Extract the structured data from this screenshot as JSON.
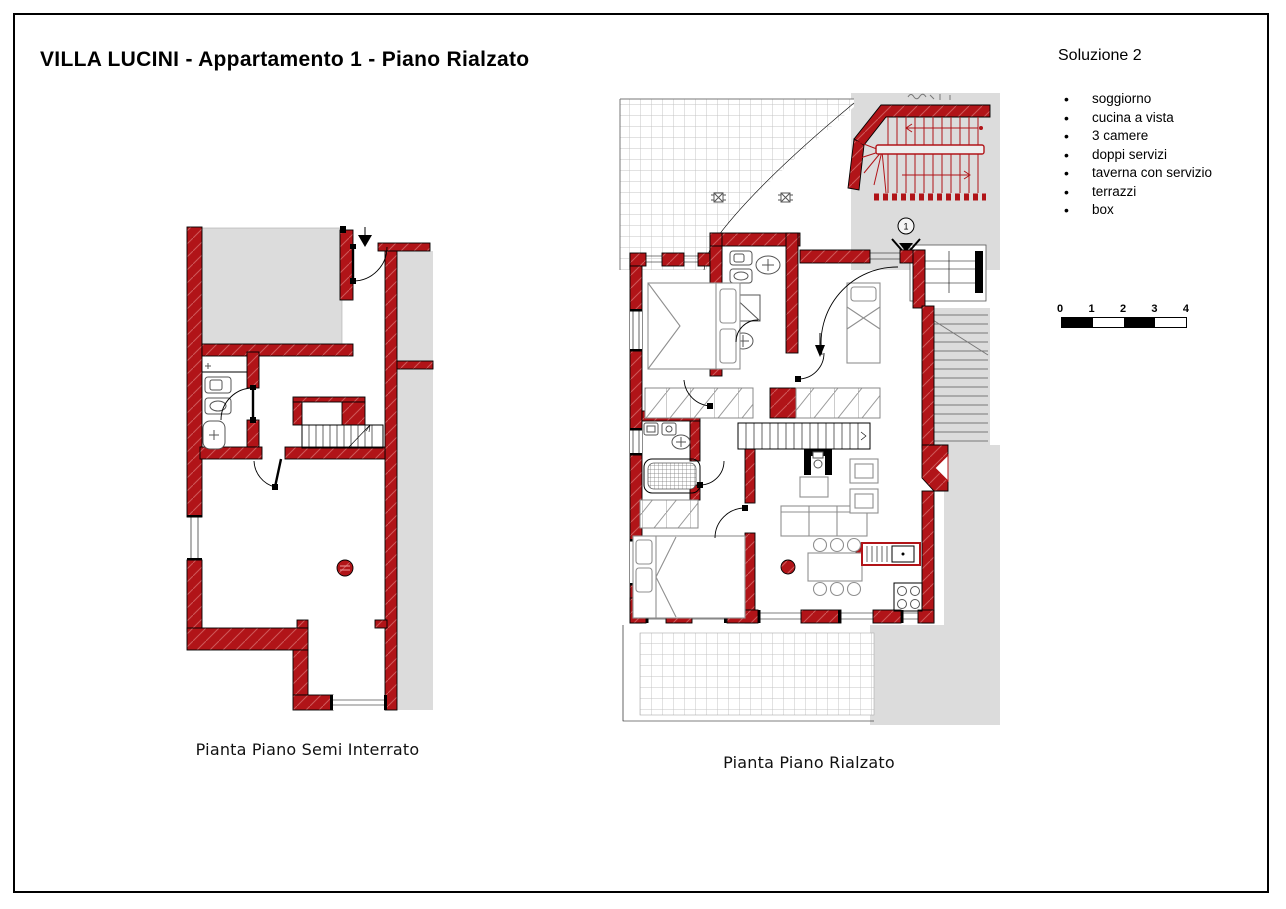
{
  "page": {
    "title": "VILLA LUCINI - Appartamento 1 - Piano Rialzato"
  },
  "solution": {
    "heading": "Soluzione 2",
    "items": [
      "soggiorno",
      "cucina a vista",
      "3 camere",
      "doppi servizi",
      "taverna con servizio",
      "terrazzi",
      "box"
    ]
  },
  "scale_bar": {
    "labels": [
      "0",
      "1",
      "2",
      "3",
      "4"
    ]
  },
  "plans": {
    "semi_interrato": {
      "caption": "Pianta Piano Semi Interrato"
    },
    "rialzato": {
      "caption": "Pianta Piano Rialzato",
      "entrance_marker": "1"
    }
  },
  "colors": {
    "wall": "#b11418",
    "wall_hatch": "#d96f6f",
    "zone_gray": "#dcdcdc",
    "tile_line": "#c4c4c4",
    "furniture_line": "#8f8f8f",
    "outline": "#000000"
  }
}
